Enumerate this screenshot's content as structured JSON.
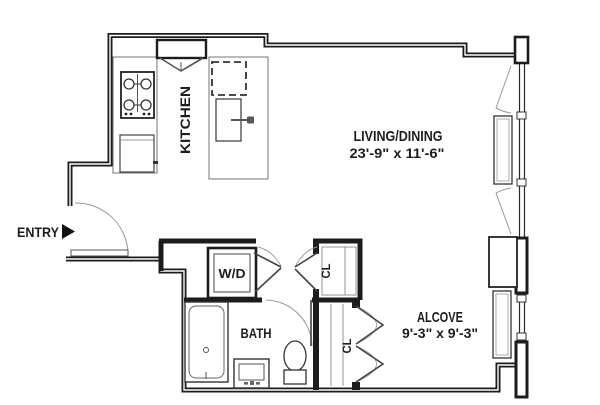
{
  "colors": {
    "wall": "#1c1c1c",
    "fixture": "#454545",
    "counter": "#767676",
    "door_swing": "#9a9a9a",
    "ink": "#1d1d1d",
    "bg": "#ffffff"
  },
  "icons": {
    "entry_marker": "right-filled-triangle"
  },
  "rooms": {
    "entry": {
      "label": "ENTRY"
    },
    "kitchen": {
      "label": "KITCHEN"
    },
    "living_dining": {
      "label": "LIVING/DINING",
      "dimensions": "23'-9\" x 11'-6\""
    },
    "alcove": {
      "label": "ALCOVE",
      "dimensions": "9'-3\" x 9'-3\""
    },
    "bath": {
      "label": "BATH"
    },
    "laundry": {
      "label": "W/D"
    },
    "closet_upper": {
      "label": "CL"
    },
    "closet_lower": {
      "label": "CL"
    }
  }
}
